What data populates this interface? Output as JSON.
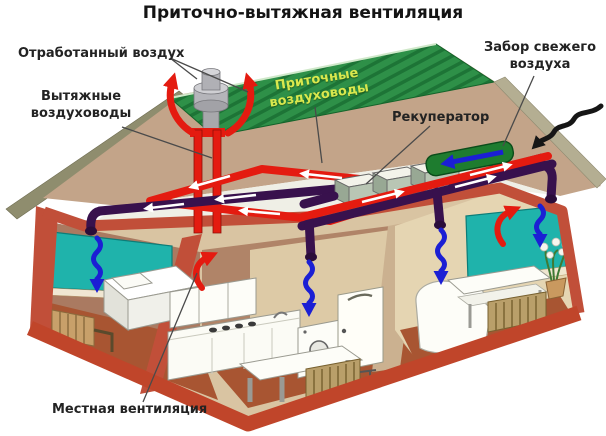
{
  "title": "Приточно-вытяжная вентиляция",
  "labels": {
    "exhaust_air": "Отработанный воздух",
    "exhaust_ducts": {
      "line1": "Вытяжные",
      "line2": "воздуховоды"
    },
    "supply_ducts": {
      "line1": "Приточные",
      "line2": "воздуховоды"
    },
    "recuperator": "Рекуператор",
    "fresh_air_intake": {
      "line1": "Забор свежего",
      "line2": "воздуха"
    },
    "local_ventilation": "Местная вентиляция"
  },
  "colors": {
    "roof_green": "#2e9048",
    "roof_stripe": "#1d7436",
    "attic_tan": "#c3a489",
    "attic_floor": "#efefe6",
    "wall_red": "#c14f39",
    "band_red": "#c0452a",
    "duct_red": "#e41b10",
    "duct_purple": "#38114d",
    "arrow_blue": "#1b1fd4",
    "wall_teal": "#1fb3ab",
    "floor_brown": "#a85532",
    "intake_green": "#1e7c2f",
    "supply_label_yellow": "#d9e84e",
    "chimney_gray": "#b5b5ba",
    "label_text": "#232323"
  }
}
